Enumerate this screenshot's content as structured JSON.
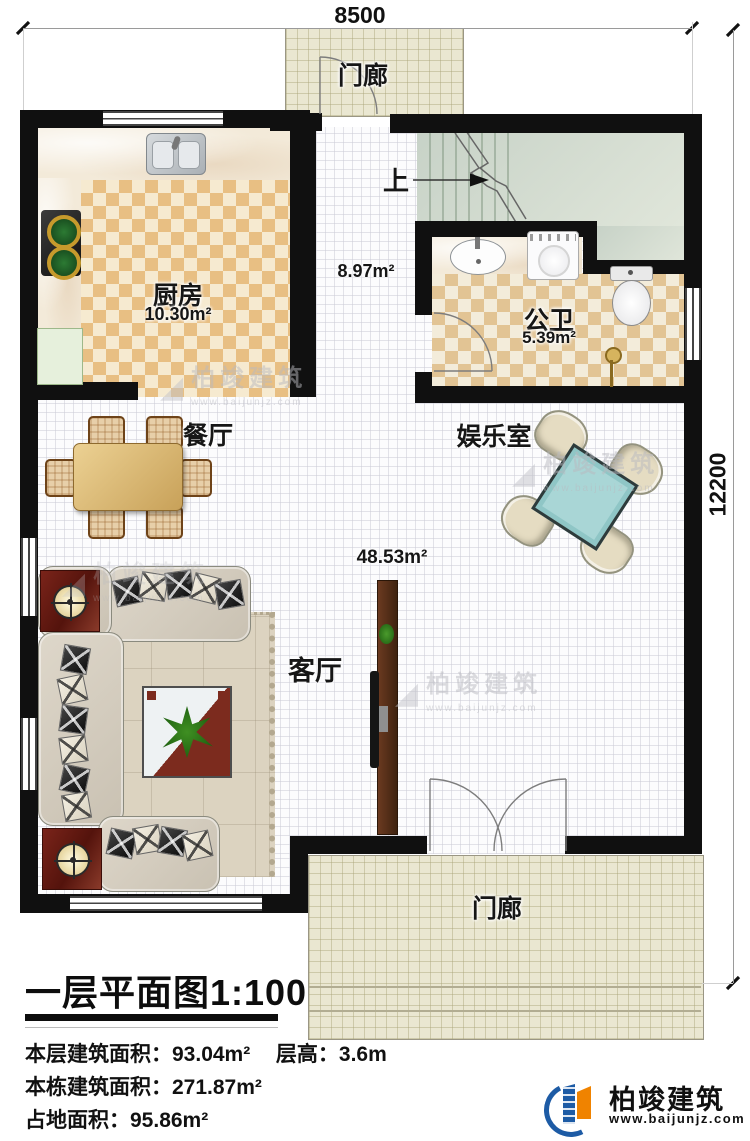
{
  "dimensions": {
    "width": "8500",
    "height": "12200"
  },
  "rooms": {
    "porch_top": {
      "label": "门廊"
    },
    "kitchen": {
      "label": "厨房",
      "area": "10.30m²"
    },
    "hallway": {
      "area": "8.97m²"
    },
    "stairs": {
      "up": "上"
    },
    "bathroom": {
      "label": "公卫",
      "area": "5.39m²"
    },
    "dining": {
      "label": "餐厅"
    },
    "entertainment": {
      "label": "娱乐室"
    },
    "living": {
      "label": "客厅",
      "area": "48.53m²"
    },
    "porch_bottom": {
      "label": "门廊"
    }
  },
  "title_block": {
    "title": "一层平面图1:100",
    "floor_area": "本层建筑面积：93.04m²",
    "floor_height": "层高：3.6m",
    "building_area": "本栋建筑面积：271.87m²",
    "land_area": "占地面积：95.86m²"
  },
  "branding": {
    "company": "柏竣建筑",
    "website": "www.baijunjz.com"
  },
  "watermark": {
    "mark": "◢",
    "company": "柏竣建筑",
    "website": "www.baijunjz.com"
  },
  "colors": {
    "wall": "#101010",
    "checker_orange": "#e8bf83",
    "checker_cream": "#f6ead0",
    "porch_tile": "#eae7d1",
    "stair_green": "#ccd7cc",
    "mahjong_teal": "#a9d6d6",
    "logo_blue": "#1d5ba5",
    "logo_orange": "#f08300"
  }
}
